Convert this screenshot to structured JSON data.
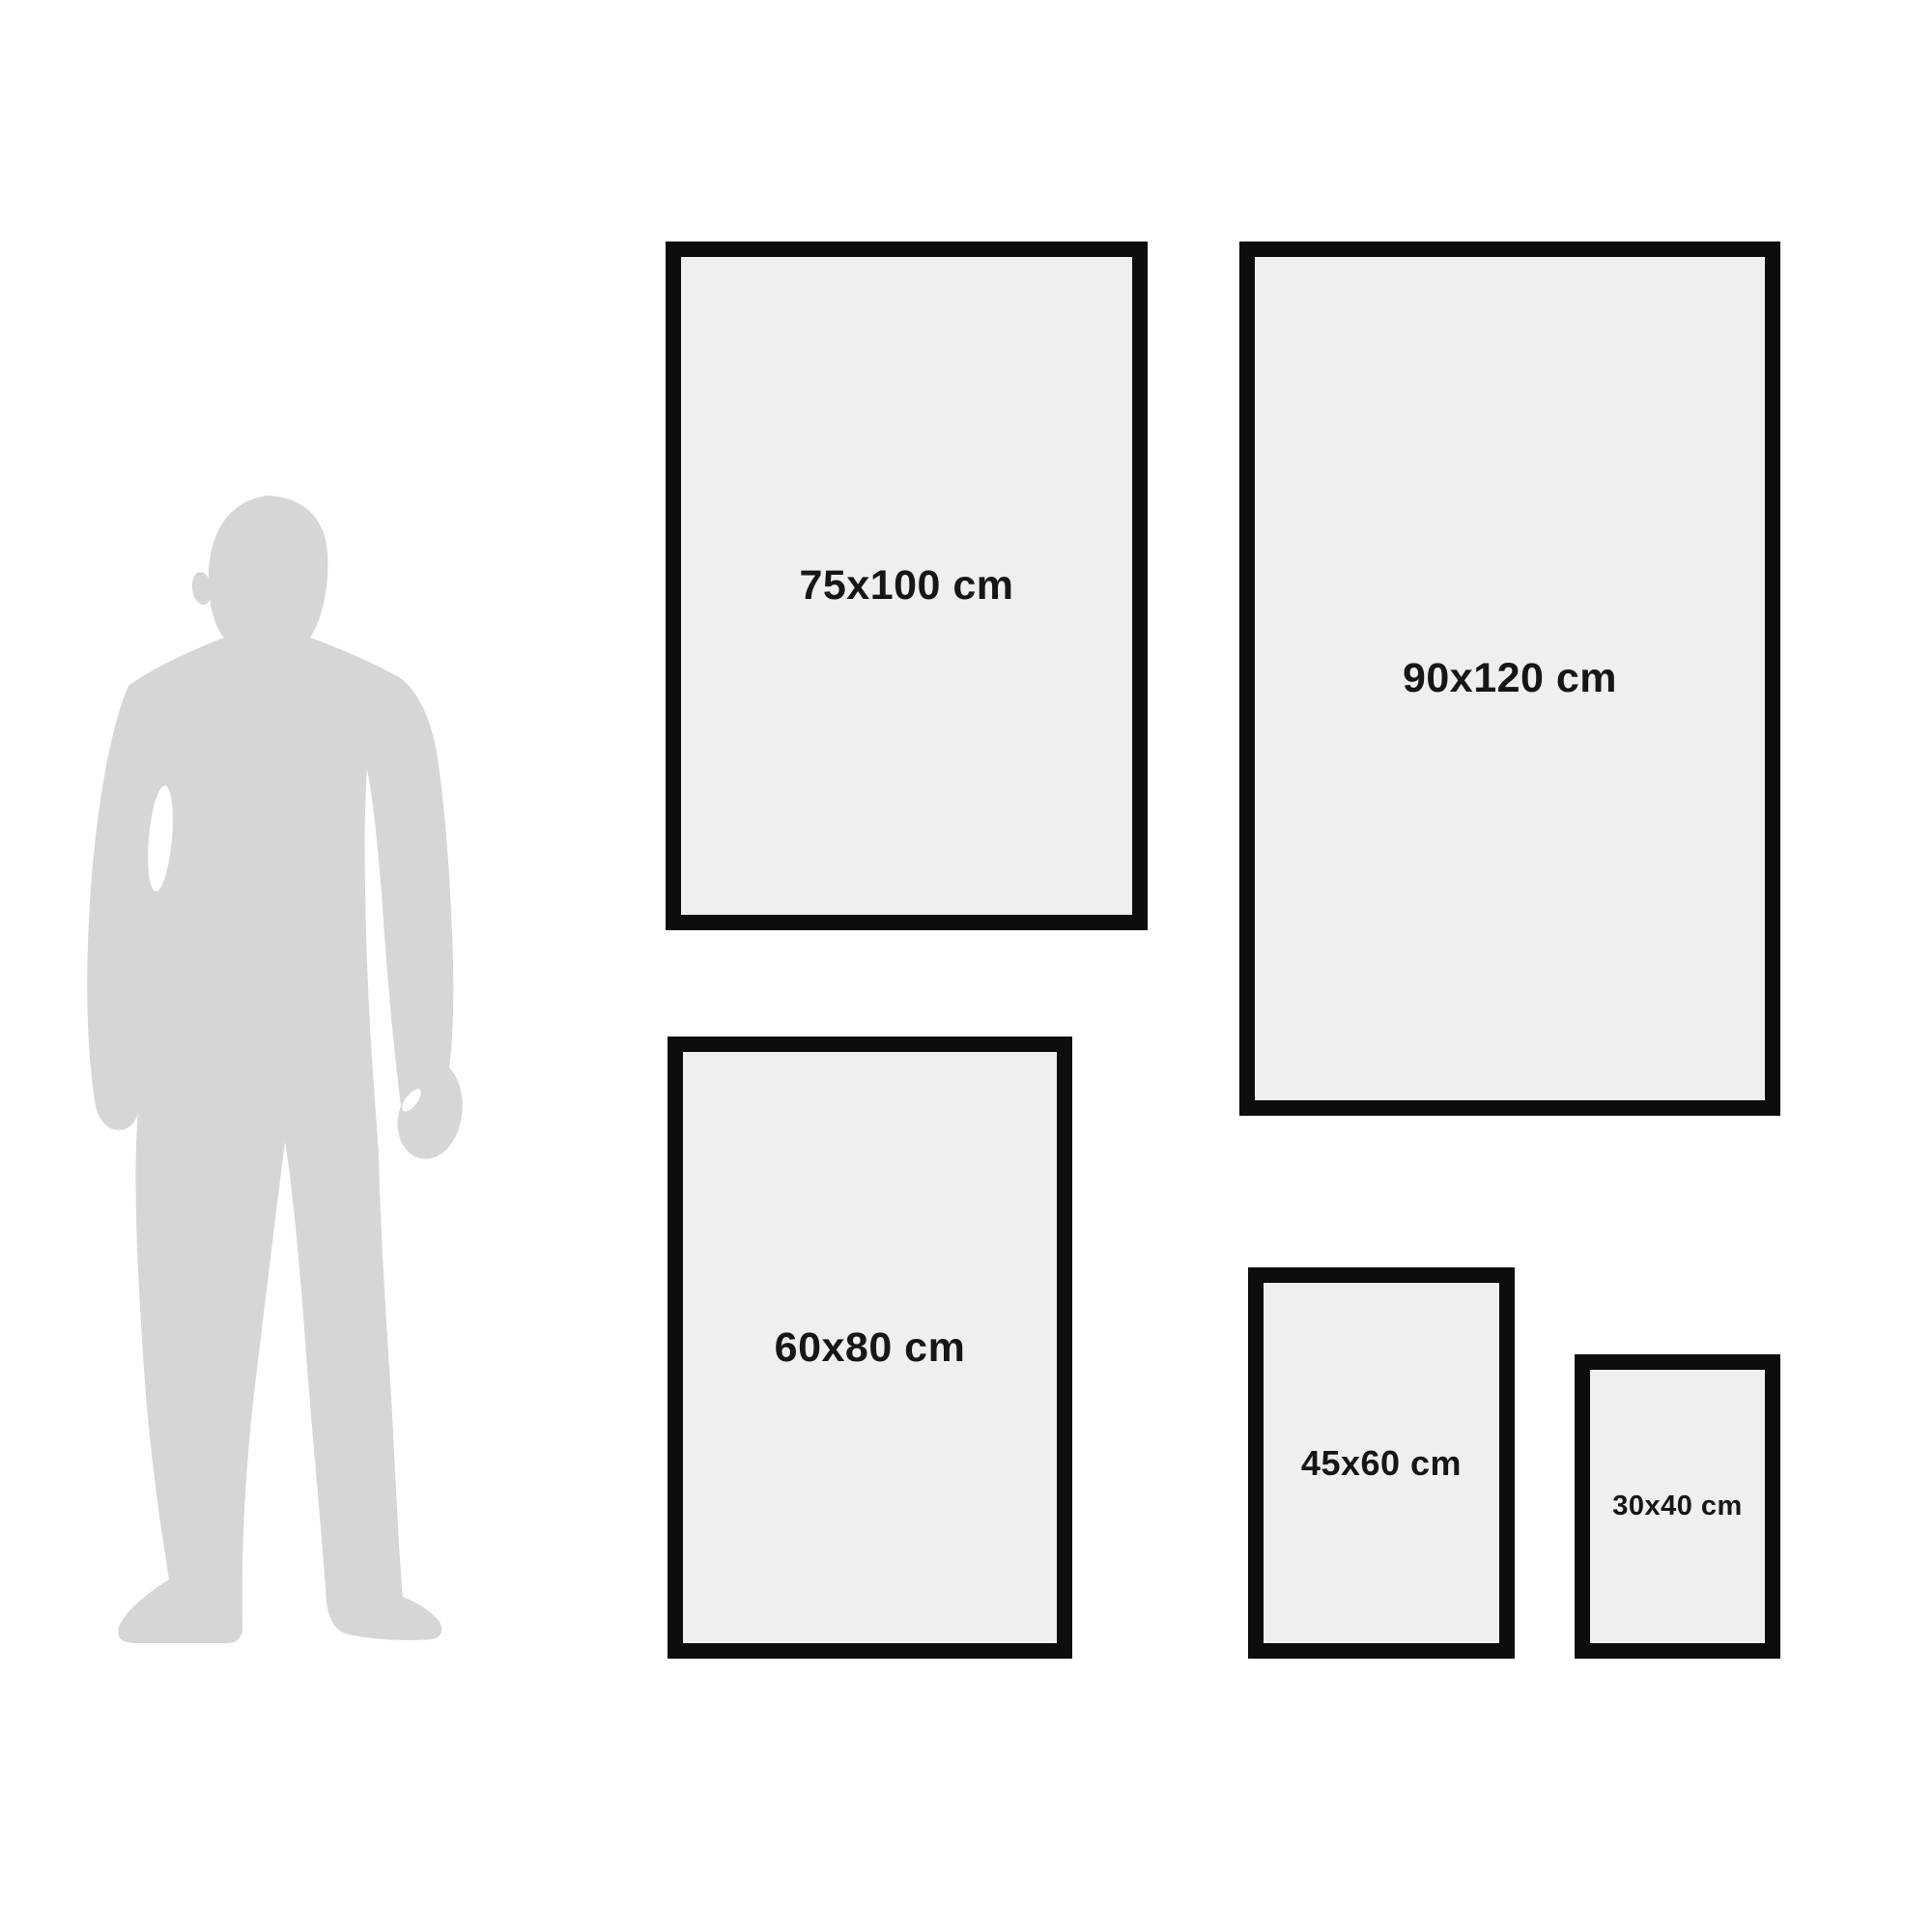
{
  "diagram": {
    "description": "Poster size comparison diagram with human silhouette for scale",
    "silhouette": {
      "subject": "standing man silhouette",
      "color": "#d6d6d6"
    },
    "frames": [
      {
        "label": "75x100 cm",
        "width_cm": 75,
        "height_cm": 100
      },
      {
        "label": "90x120 cm",
        "width_cm": 90,
        "height_cm": 120
      },
      {
        "label": "60x80 cm",
        "width_cm": 60,
        "height_cm": 80
      },
      {
        "label": "45x60 cm",
        "width_cm": 45,
        "height_cm": 60
      },
      {
        "label": "30x40 cm",
        "width_cm": 30,
        "height_cm": 40
      }
    ],
    "colors": {
      "background": "#ffffff",
      "frame_border": "#0d0d0d",
      "frame_fill": "#efefef",
      "label_text": "#161616",
      "silhouette": "#d6d6d6"
    }
  }
}
